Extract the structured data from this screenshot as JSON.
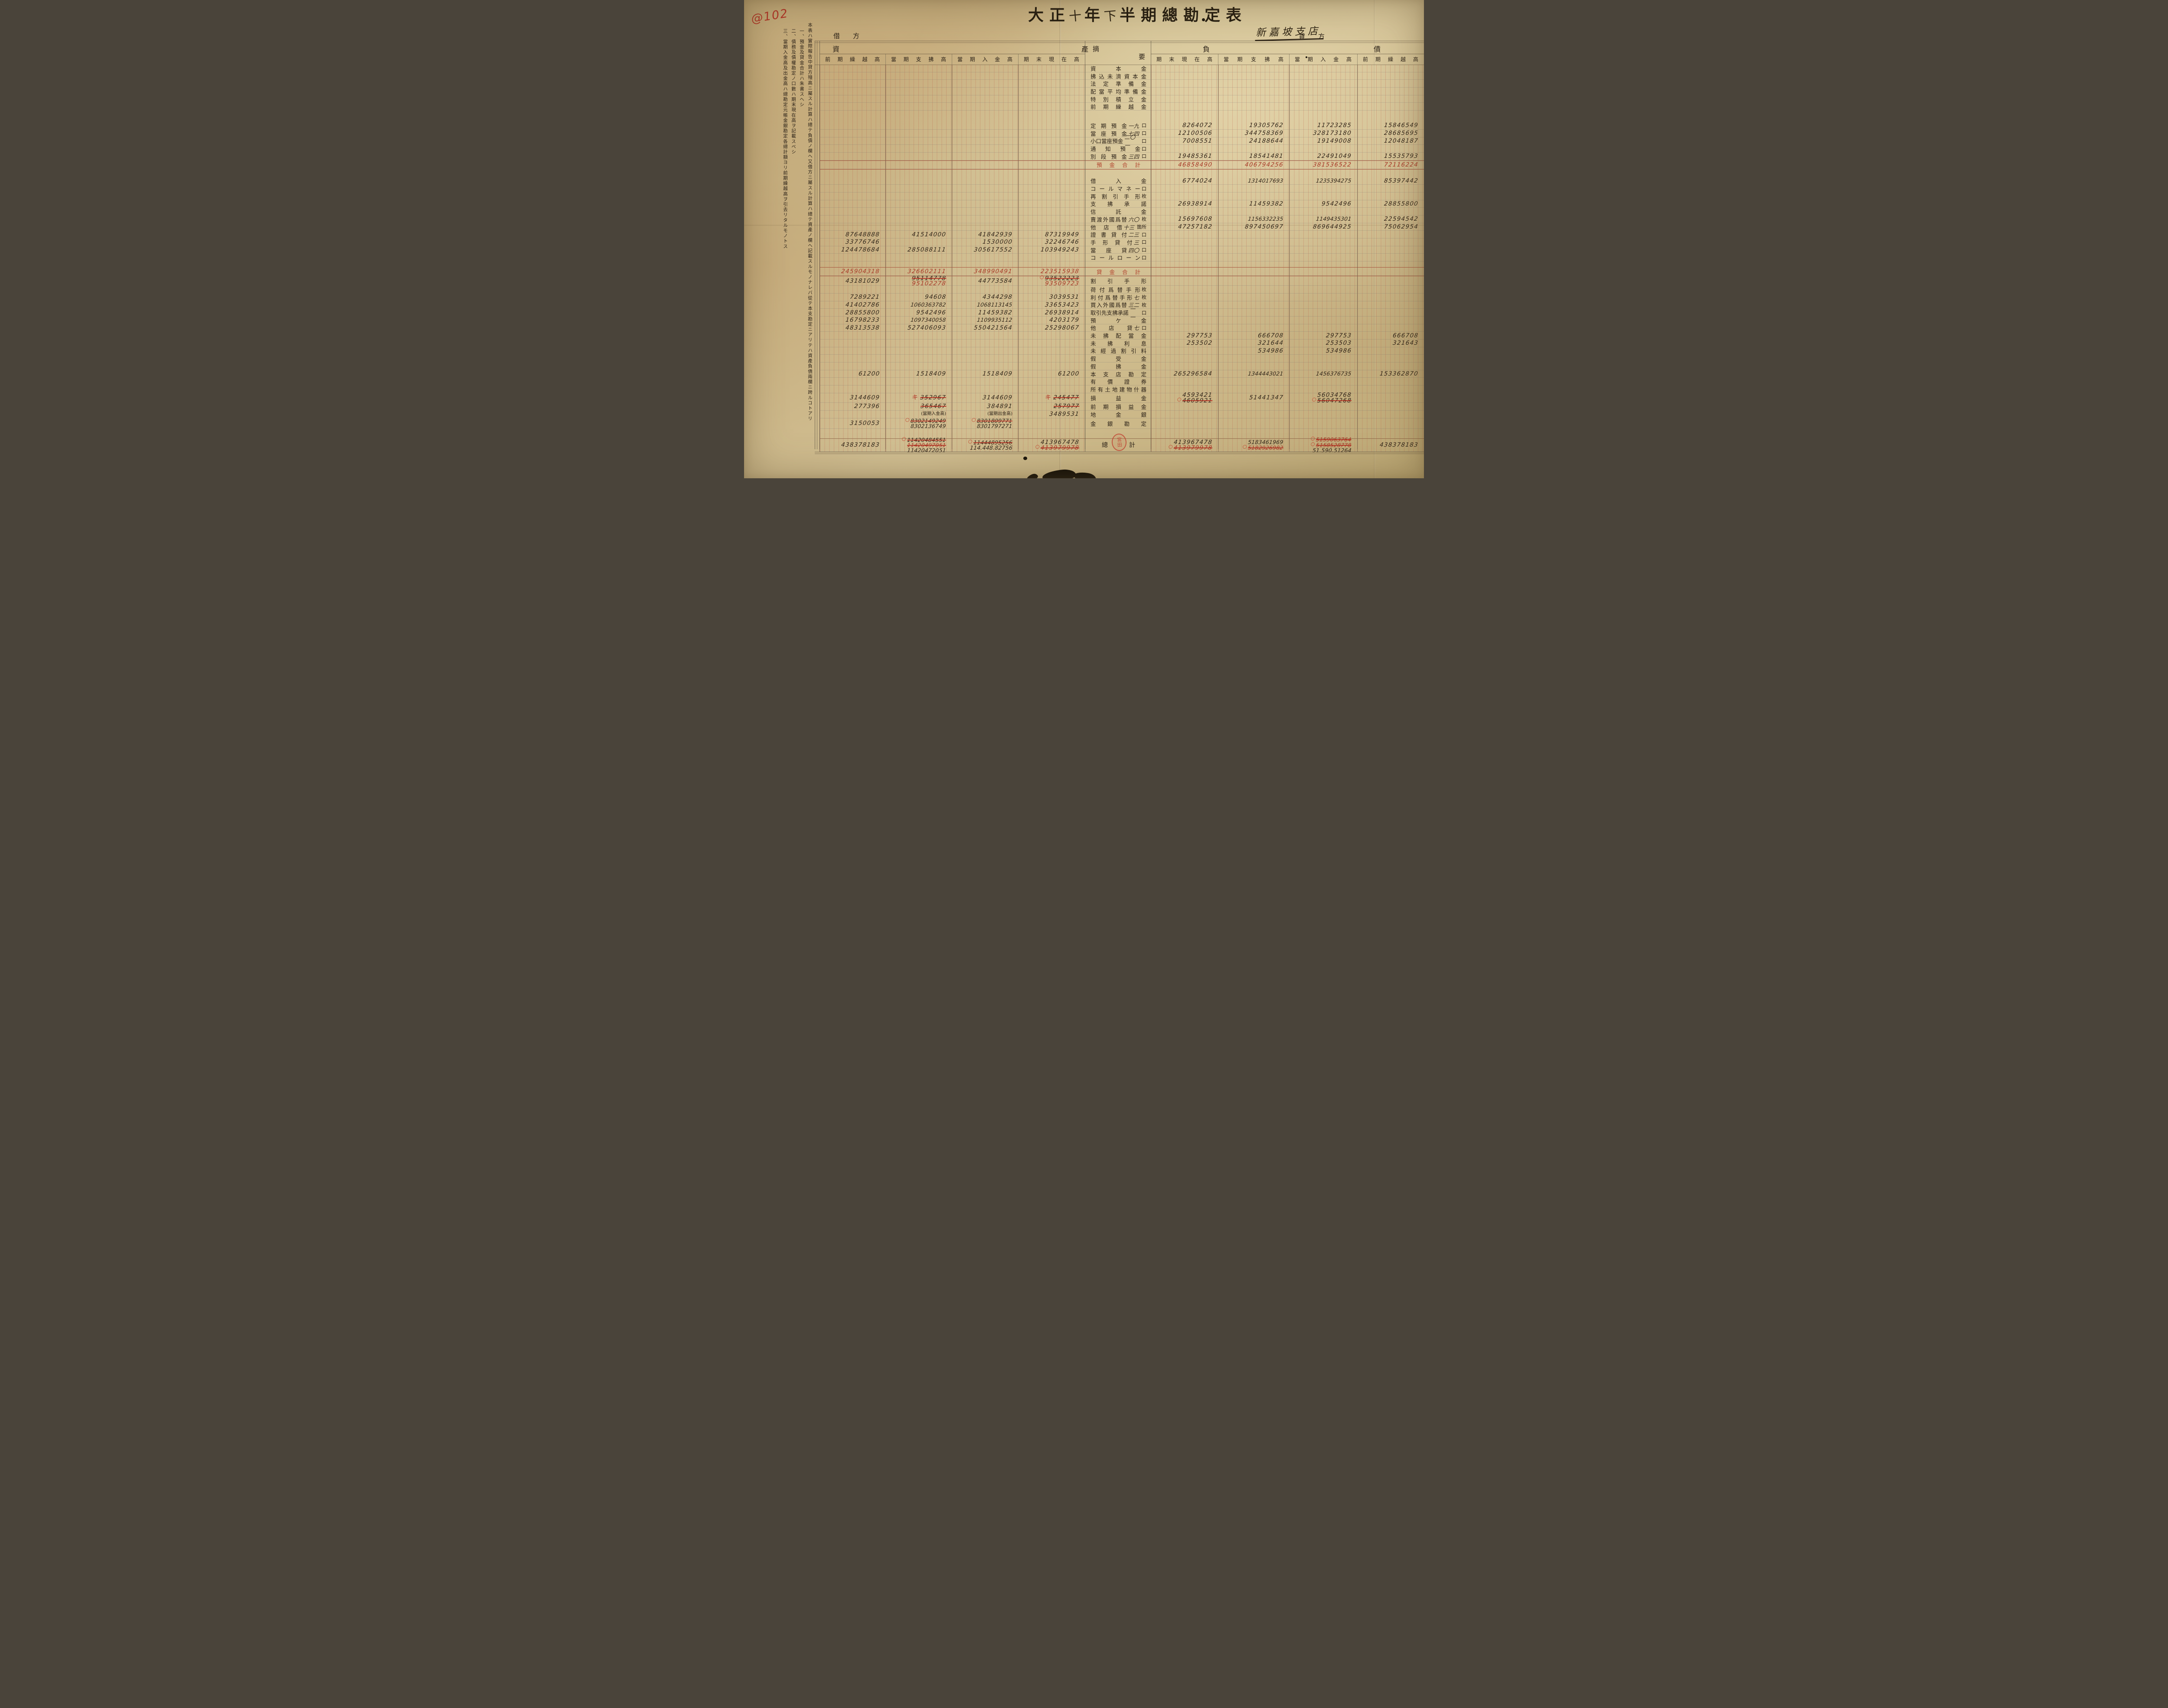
{
  "annotations": {
    "corner_code": "@102"
  },
  "title": {
    "era": "大正",
    "year_handwritten": "十",
    "year_char": "年",
    "half_handwritten": "下",
    "rest": "半期總勘定表"
  },
  "branch_name": "新嘉坡支店",
  "side_headers": {
    "debit": "借方",
    "credit": "貸方"
  },
  "group_headers": {
    "assets": "資產",
    "liabilities": "負債",
    "summary": "摘要"
  },
  "column_headers": {
    "left": [
      "前期繰越高",
      "當期支拂高",
      "當期入金高",
      "期末現在高"
    ],
    "right": [
      "期末現在高",
      "當期支拂高",
      "當期入金高",
      "前期繰越高"
    ]
  },
  "notes": [
    "本表ハ實際報告中貸方殘高ニ屬スル計算ハ總テ負債ノ欄ヘ又借方ニ屬スル計算ハ總テ資產ノ欄ヘ記載スルモノナレバ從テ本支勘定ニアリテハ資產負債兩欄ニ跨ルコトアリ",
    "一、預金及貸金合計ハ朱書スヘシ",
    "二、債務及債權勘定ノ口數ハ期末現在高ヲ記載スベシ",
    "三、當期入金高及出金高ハ總勘定元帳金銀勘定各總計額ヨリ前期繰越高ヲ引去リタルモノトス"
  ],
  "seal_text": "宮田",
  "colors": {
    "red_ink": "#a83a28",
    "black_ink": "#32261a",
    "rule_red": "#9e3e2a"
  },
  "rows": [
    {
      "name": "capital",
      "label": "資本金"
    },
    {
      "name": "unpaid-capital",
      "label": "拂込未濟資本金"
    },
    {
      "name": "legal-reserve",
      "label": "法定準備金"
    },
    {
      "name": "dividend-equalization-reserve",
      "label": "配當平均準備金"
    },
    {
      "name": "special-reserve",
      "label": "特別積立金"
    },
    {
      "name": "prev-period-carryover",
      "label": "前期繰越金"
    },
    {
      "type": "spacer",
      "h": 26
    },
    {
      "name": "time-deposits",
      "label": "定期預金",
      "count": "一九",
      "unit": "口",
      "right": [
        "8264072",
        "19305762",
        "11723285",
        "15846549"
      ]
    },
    {
      "name": "current-deposits",
      "label": "當座預金",
      "count": "七四",
      "unit": "口",
      "right": [
        "12100506",
        "344758369",
        "328173180",
        "28685695"
      ]
    },
    {
      "name": "small-current-deposits",
      "label": "小口當座預金",
      "count": "二〇一",
      "unit": "口",
      "right": [
        "7008551",
        "24188644",
        "19149008",
        "12048187"
      ]
    },
    {
      "name": "notice-deposits",
      "label": "通知預金",
      "unit": "口"
    },
    {
      "name": "special-deposits",
      "label": "別段預金",
      "count": "三四",
      "unit": "口",
      "right": [
        "19485361",
        "18541481",
        "22491049",
        "15535793"
      ]
    },
    {
      "name": "deposits-total",
      "type": "subtotal",
      "label": "預金合計",
      "right": [
        [
          {
            "t": "46858490",
            "s": "r"
          }
        ],
        [
          {
            "t": "406794256",
            "s": "r"
          }
        ],
        [
          {
            "t": "381536522",
            "s": "r"
          }
        ],
        [
          {
            "t": "72116224",
            "s": "r"
          }
        ]
      ]
    },
    {
      "type": "spacer",
      "h": 18
    },
    {
      "name": "borrowings",
      "label": "借入金",
      "right": [
        "6774024",
        "1314017693",
        "1235394275",
        "85397442"
      ]
    },
    {
      "name": "call-money",
      "label": "コールマネー",
      "unit": "口"
    },
    {
      "name": "rediscounted-bills",
      "label": "再割引手形",
      "unit": "枚"
    },
    {
      "name": "acceptances",
      "label": "支拂承諾",
      "right": [
        "26938914",
        "11459382",
        "9542496",
        "28855800"
      ]
    },
    {
      "name": "trust-money",
      "label": "信託金"
    },
    {
      "name": "sold-foreign-exchange",
      "label": "賣渡外國爲替",
      "count": "六〇",
      "unit": "枚",
      "right": [
        "15697608",
        "1156332235",
        "1149435301",
        "22594542"
      ]
    },
    {
      "name": "due-to-other-branches",
      "label": "他店借",
      "count": "十三",
      "unit": "箇所",
      "right": [
        "47257182",
        "897450697",
        "869644925",
        "75062954"
      ]
    },
    {
      "name": "loans-on-deeds",
      "label": "證書貸付",
      "count": "二三",
      "unit": "口",
      "left": [
        "87648888",
        "41514000",
        "41842939",
        "87319949"
      ]
    },
    {
      "name": "loans-on-bills",
      "label": "手形貸付",
      "count": "三",
      "unit": "口",
      "left": [
        "33776746",
        "",
        "1530000",
        "32246746"
      ]
    },
    {
      "name": "overdrafts",
      "label": "當座貸",
      "count": "四〇",
      "unit": "口",
      "left": [
        "124478684",
        "285088111",
        "305617552",
        "103949243"
      ]
    },
    {
      "name": "call-loans",
      "label": "コールローン",
      "unit": "口"
    },
    {
      "type": "spacer",
      "h": 13
    },
    {
      "name": "loans-total",
      "type": "subtotal",
      "label": "貸金合計",
      "left": [
        [
          {
            "t": "245904318",
            "s": "r"
          }
        ],
        [
          {
            "t": "326602111",
            "s": "r"
          }
        ],
        [
          {
            "t": "348990491",
            "s": "r"
          }
        ],
        [
          {
            "t": "223515938",
            "s": "r"
          }
        ]
      ]
    },
    {
      "name": "discounted-bills",
      "label": "割引手形",
      "h": 22,
      "left": [
        "43181029",
        [
          {
            "t": "95114778",
            "s": "hx"
          },
          {
            "t": "95102278",
            "s": "r"
          }
        ],
        "44773584",
        [
          {
            "t": "93522223",
            "s": "hx",
            "m": true
          },
          {
            "t": "93509723",
            "s": "r"
          }
        ]
      ]
    },
    {
      "name": "documentary-bills",
      "label": "荷付爲替手形",
      "unit": "枚"
    },
    {
      "name": "interest-bearing-bills",
      "label": "利付爲替手形",
      "count": "七",
      "unit": "枚",
      "left": [
        "7289221",
        "94608",
        "4344298",
        "3039531"
      ]
    },
    {
      "name": "bought-foreign-exchange",
      "label": "買入外國爲替",
      "count": "三二",
      "unit": "枚",
      "left": [
        "41402786",
        "1060363782",
        "1068113145",
        "33653423"
      ]
    },
    {
      "name": "customer-acceptances",
      "label": "取引先支拂承諾",
      "count": "一一",
      "unit": "口",
      "left": [
        "28855800",
        "9542496",
        "11459382",
        "26938914"
      ]
    },
    {
      "name": "deposits-with-others",
      "label": "預ケ金",
      "left": [
        "16798233",
        "1097340058",
        "1109935112",
        "4203179"
      ]
    },
    {
      "name": "due-from-other-branches",
      "label": "他店貸",
      "count": "七",
      "unit": "口",
      "left": [
        "48313538",
        "527406093",
        "550421564",
        "25298067"
      ]
    },
    {
      "name": "unpaid-dividends",
      "label": "未拂配當金",
      "right": [
        "297753",
        "666708",
        "297753",
        "666708"
      ]
    },
    {
      "name": "unpaid-interest",
      "label": "未拂利息",
      "right": [
        "253502",
        "321644",
        "253503",
        "321643"
      ]
    },
    {
      "name": "unearned-discount",
      "label": "未經過割引料",
      "right": [
        "",
        "534986",
        "534986",
        ""
      ]
    },
    {
      "name": "suspense-receipts",
      "label": "假受金"
    },
    {
      "name": "suspense-payments",
      "label": "假拂金"
    },
    {
      "name": "head-office-account",
      "label": "本支店勘定",
      "left": [
        "61200",
        "1518409",
        "1518409",
        "61200"
      ],
      "right": [
        "265296584",
        "1344443021",
        "1456376735",
        "153362870"
      ]
    },
    {
      "name": "securities",
      "label": "有價證券"
    },
    {
      "name": "premises",
      "label": "所有土地建物什器"
    },
    {
      "name": "profit-loss",
      "label": "損益金",
      "h": 22,
      "left": [
        "3144609",
        [
          {
            "t": "352967",
            "s": "hx",
            "ki": true
          }
        ],
        "3144609",
        [
          {
            "t": "245477",
            "s": "hx",
            "ki": true
          }
        ]
      ],
      "right": [
        [
          {
            "t": "4593421"
          },
          {
            "t": "4605921",
            "s": "hx",
            "m": true
          }
        ],
        "51441347",
        [
          {
            "t": "56034768"
          },
          {
            "t": "56047268",
            "s": "hx",
            "m": true
          }
        ],
        ""
      ]
    },
    {
      "name": "prev-profit-loss",
      "label": "前期損益金",
      "h": 18,
      "left": [
        "277396",
        [
          {
            "t": "365467",
            "s": "hx"
          }
        ],
        "384891",
        [
          {
            "t": "257977",
            "s": "hx"
          }
        ]
      ]
    },
    {
      "name": "bullion",
      "label": "地金銀",
      "h": 18,
      "left": [
        "",
        [
          {
            "t": "(當期入金高)",
            "s": "note"
          }
        ],
        [
          {
            "t": "(當期出金高)",
            "s": "note"
          }
        ],
        "3489531"
      ]
    },
    {
      "name": "cash-account",
      "label": "金銀勘定",
      "h": 24,
      "left": [
        "3150053",
        [
          {
            "t": "8302149249",
            "s": "hx",
            "m": true
          },
          {
            "t": "8302136749"
          }
        ],
        [
          {
            "t": "8301809771",
            "s": "hx",
            "m": true
          },
          {
            "t": "8301797271"
          }
        ],
        ""
      ]
    },
    {
      "type": "spacer",
      "h": 22
    },
    {
      "name": "grand-total",
      "type": "total",
      "label": "總計",
      "h": 30,
      "left": [
        "438378183",
        [
          {
            "t": "11420484551",
            "s": "hx",
            "m": true
          },
          {
            "t": "11420497051",
            "s": "rx"
          },
          {
            "t": "11420472051"
          }
        ],
        [
          {
            "t": "11444895256",
            "s": "hx",
            "m": true
          },
          {
            "t": "114.448.82756"
          }
        ],
        [
          {
            "t": "413967478"
          },
          {
            "t": "413979978",
            "s": "rx",
            "m": true
          }
        ]
      ],
      "right": [
        [
          {
            "t": "413967478"
          },
          {
            "t": "413979978",
            "s": "rx",
            "m": true
          }
        ],
        [
          {
            "t": "5183461969"
          },
          {
            "t": "5182926982",
            "s": "rx",
            "m": true
          }
        ],
        [
          {
            "t": "5159063764",
            "s": "rx",
            "m": true
          },
          {
            "t": "5158528778",
            "s": "rx",
            "m": true
          },
          {
            "t": "51.590.51264"
          }
        ],
        "438378183"
      ]
    }
  ]
}
